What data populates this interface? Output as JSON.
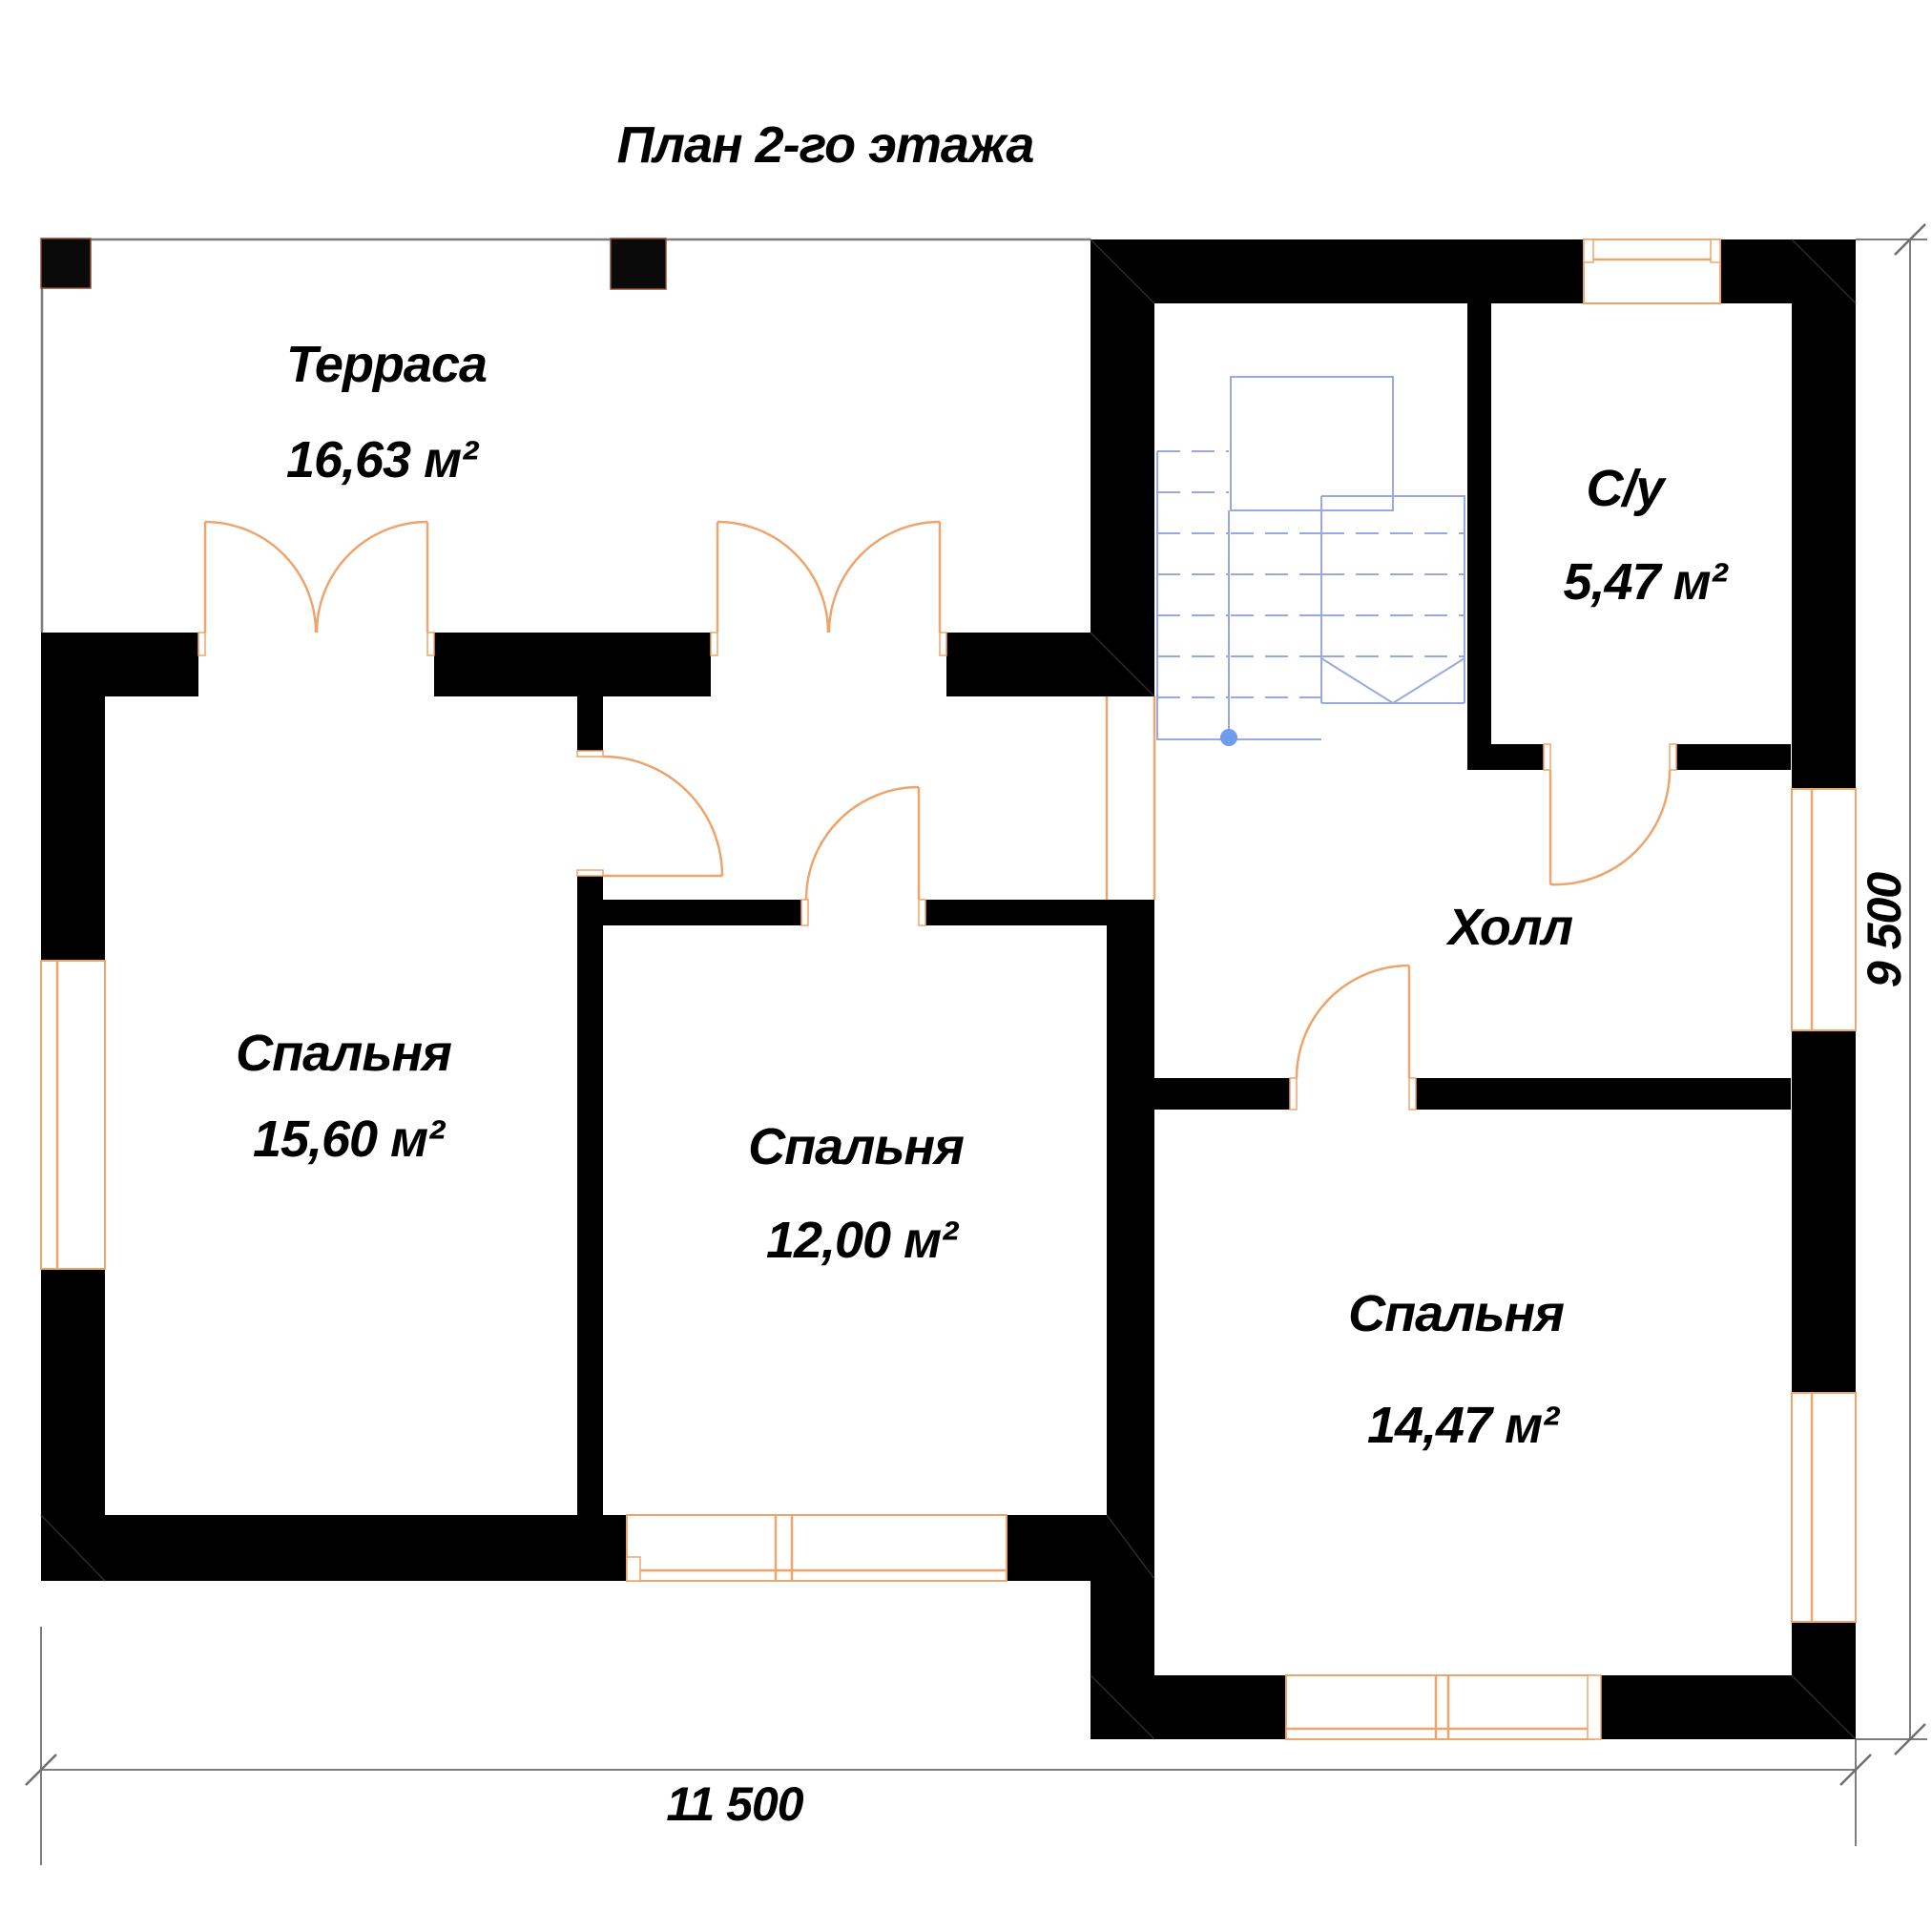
{
  "title": "План 2-го этажа",
  "rooms": {
    "terrace": {
      "name": "Терраса",
      "area": "16,63 м²"
    },
    "bathroom": {
      "name": "С/у",
      "area": "5,47 м²"
    },
    "bedroom_left": {
      "name": "Спальня",
      "area": "15,60 м²"
    },
    "bedroom_middle": {
      "name": "Спальня",
      "area": "12,00 м²"
    },
    "hall": {
      "name": "Холл"
    },
    "bedroom_right": {
      "name": "Спальня",
      "area": "14,47 м²"
    }
  },
  "dimensions": {
    "bottom_width": "11 500",
    "right_height": "9 500"
  },
  "colors": {
    "walls": "#000000",
    "doors_windows": "#eda56e",
    "stairs": "#9aa8e0",
    "stairs_dot": "#6f9ceb",
    "dimension_lines": "#7d7d7d",
    "text": "#000000",
    "background": "#ffffff"
  }
}
